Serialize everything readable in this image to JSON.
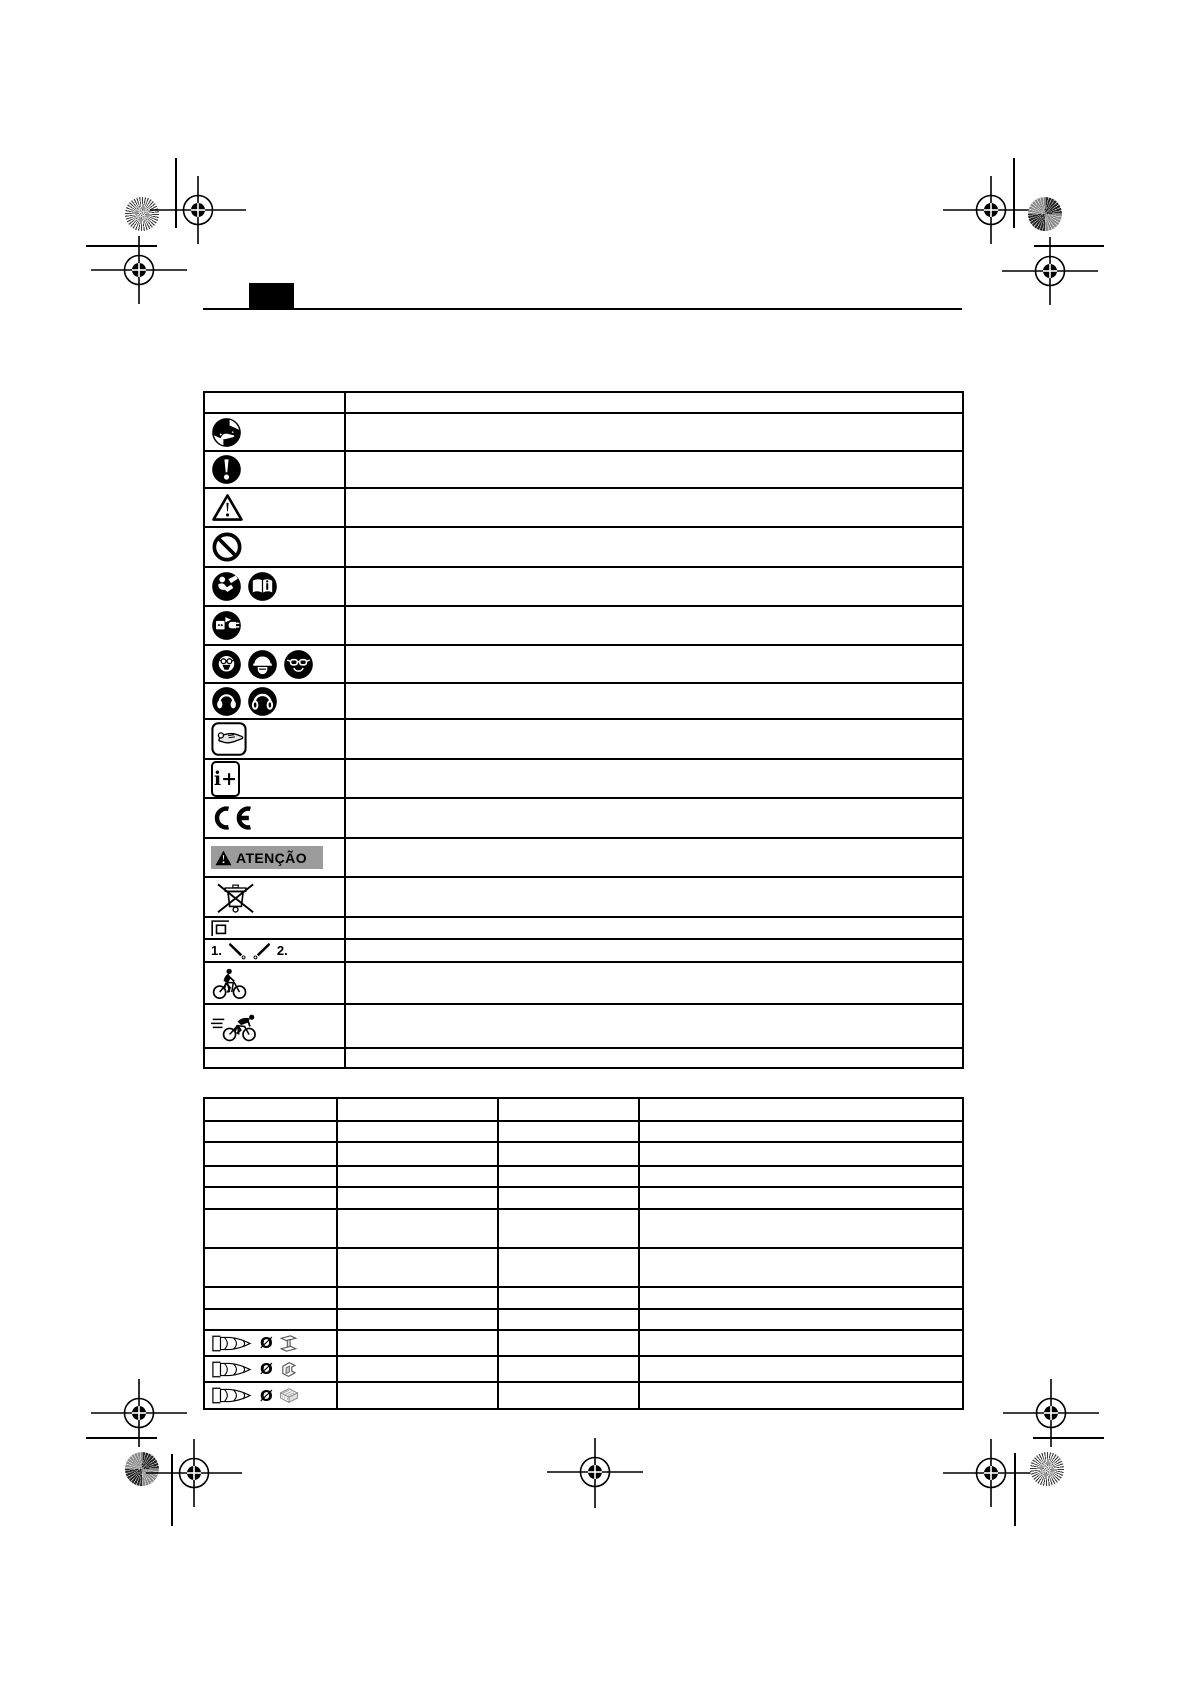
{
  "document": {
    "kind": "manual-symbols-page",
    "background": "#ffffff",
    "ink": "#000000",
    "banner_gray": "#9c9c9c"
  },
  "labels": {
    "atencao": "ATENÇÃO",
    "step1": "1.",
    "step2": "2.",
    "diameter": "Ø",
    "info_plus": "i+",
    "ce": "CE"
  },
  "symbols_table": {
    "columns": [
      "symbol",
      "meaning"
    ],
    "rows": [
      {
        "icons": [
          "do-not-touch-prohibition-icon"
        ],
        "meaning": ""
      },
      {
        "icons": [
          "mandatory-action-icon"
        ],
        "meaning": ""
      },
      {
        "icons": [
          "warning-triangle-icon"
        ],
        "meaning": ""
      },
      {
        "icons": [
          "prohibition-icon"
        ],
        "meaning": ""
      },
      {
        "icons": [
          "read-manual-icon",
          "instruction-book-icon"
        ],
        "meaning": ""
      },
      {
        "icons": [
          "unplug-icon"
        ],
        "meaning": ""
      },
      {
        "icons": [
          "dust-mask-icon",
          "face-shield-icon",
          "safety-goggles-icon"
        ],
        "meaning": ""
      },
      {
        "icons": [
          "ear-protection-icon",
          "ear-protection-large-icon"
        ],
        "meaning": ""
      },
      {
        "icons": [
          "hand-grip-icon"
        ],
        "meaning": ""
      },
      {
        "icons": [
          "more-information-icon"
        ],
        "meaning": ""
      },
      {
        "icons": [
          "ce-mark-icon"
        ],
        "meaning": ""
      },
      {
        "icons": [
          "atencao-warning-banner"
        ],
        "meaning": ""
      },
      {
        "icons": [
          "weee-crossed-bin-icon"
        ],
        "meaning": ""
      },
      {
        "icons": [
          "protection-class-2-icon"
        ],
        "meaning": ""
      },
      {
        "icons": [
          "bit-angle-steps-icon"
        ],
        "meaning": ""
      },
      {
        "icons": [
          "cyclist-icon"
        ],
        "meaning": ""
      },
      {
        "icons": [
          "racing-cyclist-icon"
        ],
        "meaning": ""
      },
      {
        "icons": [],
        "meaning": ""
      }
    ]
  },
  "spec_table": {
    "columns": [
      "",
      "",
      "",
      ""
    ],
    "rows": [
      {
        "cells": [
          "",
          "",
          "",
          ""
        ]
      },
      {
        "cells": [
          "",
          "",
          "",
          ""
        ]
      },
      {
        "cells": [
          "",
          "",
          "",
          ""
        ]
      },
      {
        "cells": [
          "",
          "",
          "",
          ""
        ]
      },
      {
        "cells": [
          "",
          "",
          "",
          ""
        ]
      },
      {
        "cells": [
          "",
          "",
          "",
          ""
        ]
      },
      {
        "cells": [
          "",
          "",
          "",
          ""
        ]
      },
      {
        "cells": [
          "",
          "",
          "",
          ""
        ]
      },
      {
        "icons": [
          "drill-bit-icon",
          "diameter-symbol",
          "steel-beam-icon"
        ],
        "cells": [
          "",
          "",
          ""
        ]
      },
      {
        "icons": [
          "drill-bit-icon",
          "diameter-symbol",
          "metal-profile-icon"
        ],
        "cells": [
          "",
          "",
          ""
        ]
      },
      {
        "icons": [
          "drill-bit-icon",
          "diameter-symbol",
          "wood-block-icon"
        ],
        "cells": [
          "",
          "",
          ""
        ]
      }
    ]
  },
  "print_marks": {
    "registration_targets": 9,
    "star_targets": 4,
    "crop_lines": 8
  }
}
